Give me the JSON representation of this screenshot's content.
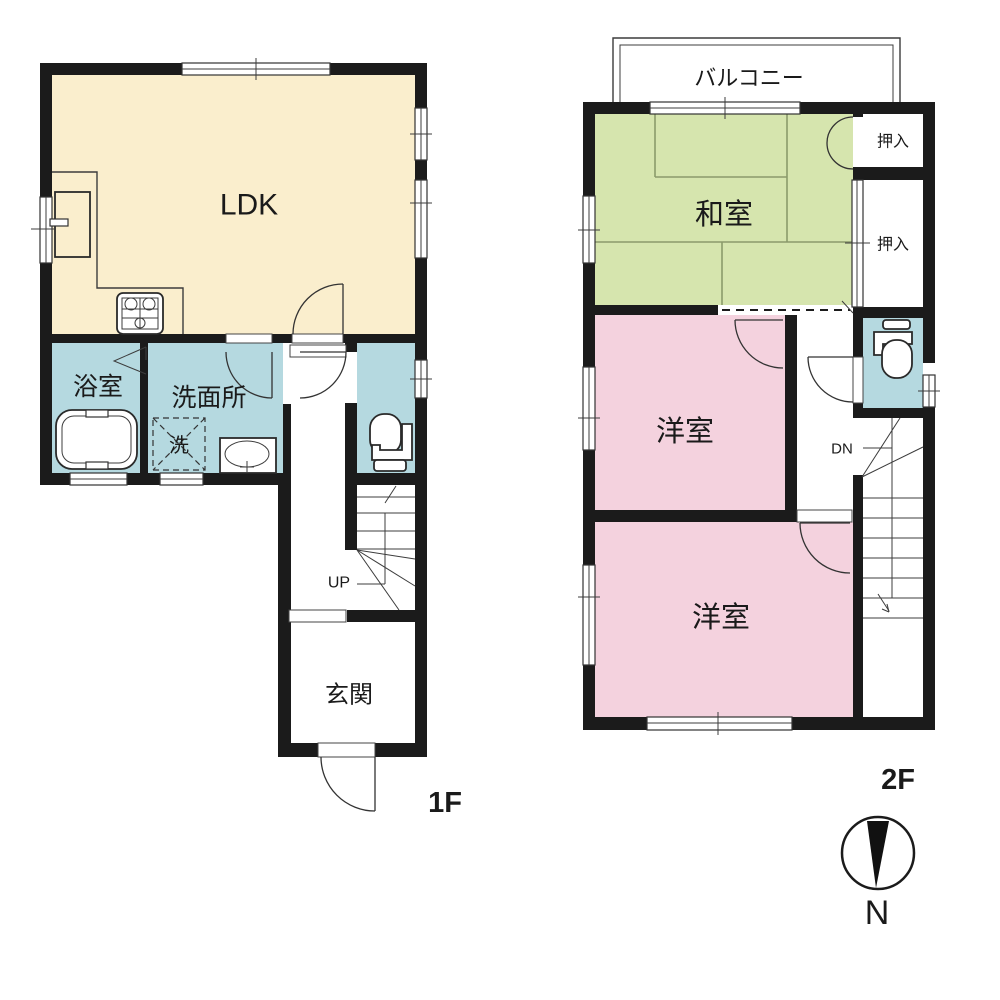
{
  "document": {
    "type_label": "floor-plan",
    "colors": {
      "wall": "#1b1b1b",
      "ldk_fill": "#faeecd",
      "wet_area_fill": "#b5d9e0",
      "tatami_fill": "#d6e5ae",
      "western_room_fill": "#f4d2de",
      "background": "#ffffff"
    }
  },
  "floors": [
    {
      "label": "1F",
      "rooms": [
        {
          "key": "ldk",
          "label": "LDK"
        },
        {
          "key": "bathroom",
          "label": "浴室"
        },
        {
          "key": "washroom",
          "label": "洗面所"
        },
        {
          "key": "entrance",
          "label": "玄関"
        }
      ],
      "fixtures": [
        {
          "key": "washing-machine",
          "label": "洗"
        },
        {
          "key": "bathtub",
          "label": ""
        },
        {
          "key": "sink",
          "label": ""
        },
        {
          "key": "toilet",
          "label": ""
        },
        {
          "key": "stove",
          "label": ""
        }
      ],
      "stairs": {
        "direction_label": "UP"
      }
    },
    {
      "label": "2F",
      "rooms": [
        {
          "key": "balcony",
          "label": "バルコニー"
        },
        {
          "key": "japanese-room",
          "label": "和室"
        },
        {
          "key": "closet-upper",
          "label": "押入"
        },
        {
          "key": "closet-lower",
          "label": "押入"
        },
        {
          "key": "western-room-1",
          "label": "洋室"
        },
        {
          "key": "western-room-2",
          "label": "洋室"
        }
      ],
      "fixtures": [
        {
          "key": "toilet",
          "label": ""
        }
      ],
      "stairs": {
        "direction_label": "DN"
      }
    }
  ],
  "compass": {
    "label": "N"
  }
}
